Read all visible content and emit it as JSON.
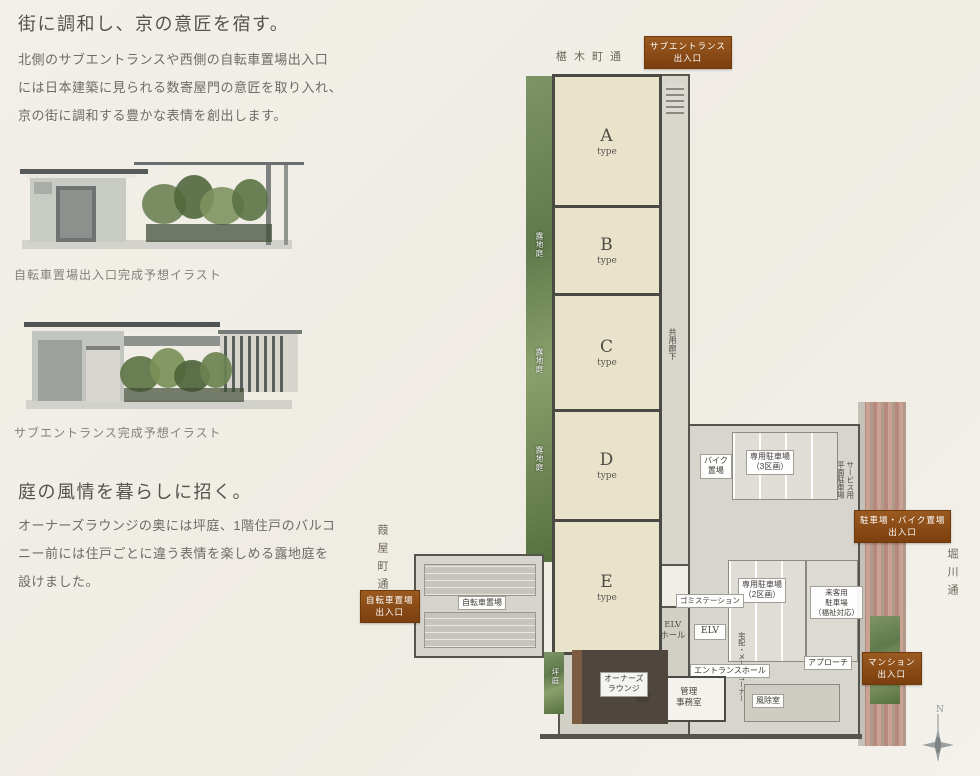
{
  "colors": {
    "badge_brown": "#8d4e17",
    "wall_gray": "#4b4944",
    "unit_floor": "#eae3cc",
    "garden_green": "#6f8757",
    "paper": "#f1eee6"
  },
  "left_column": {
    "section_design": {
      "heading": "街に調和し、京の意匠を宿す。",
      "body": "北側のサブエントランスや西側の自転車置場出入口\nには日本建築に見られる数寄屋門の意匠を取り入れ、\n京の街に調和する豊かな表情を創出します。",
      "illustration1_caption": "自転車置場出入口完成予想イラスト",
      "illustration2_caption": "サブエントランス完成予想イラスト"
    },
    "section_garden": {
      "heading": "庭の風情を暮らしに招く。",
      "body": "オーナーズラウンジの奥には坪庭、1階住戸のバルコ\nニー前には住戸ごとに違う表情を楽しめる露地庭を\n設けました。"
    }
  },
  "plan": {
    "streets": {
      "top": "椹木町通",
      "west": "葭屋町通",
      "east": "堀川通"
    },
    "badges": {
      "sub_entrance": "サブエントランス\n出入口",
      "bicycle_entrance": "自転車置場\n出入口",
      "parking_bike_entrance": "駐車場・バイク置場\n出入口",
      "mansion_entrance": "マンション\n出入口"
    },
    "units": [
      {
        "letter": "A",
        "type_word": "type"
      },
      {
        "letter": "B",
        "type_word": "type"
      },
      {
        "letter": "C",
        "type_word": "type"
      },
      {
        "letter": "D",
        "type_word": "type"
      },
      {
        "letter": "E",
        "type_word": "type"
      }
    ],
    "rooms": {
      "corridor": "共用廊下",
      "garden_strip_1": "露地庭",
      "garden_strip_2": "露地庭",
      "garden_strip_3": "露地庭",
      "tsubo_garden": "坪庭",
      "bike_storage": "バイク\n置場",
      "private_parking_3": "専用駐車場\n（3区画）",
      "service_parking": "サービス用\n平面駐車場",
      "private_parking_2": "専用駐車場\n（2区画）",
      "visitor_parking": "来客用\n駐車場\n（福祉対応）",
      "garbage_station": "ゴミステーション",
      "elv_hall": "ELV\nホール",
      "elv": "ELV",
      "delivery_mail": "宅配・メールコーナー",
      "entrance_hall": "エントランスホール",
      "office": "管理\n事務室",
      "windbreak": "風除室",
      "approach": "アプローチ",
      "owners_lounge": "オーナーズ\nラウンジ",
      "bicycle_parking": "自転車置場"
    },
    "compass": {
      "north": "N"
    }
  }
}
